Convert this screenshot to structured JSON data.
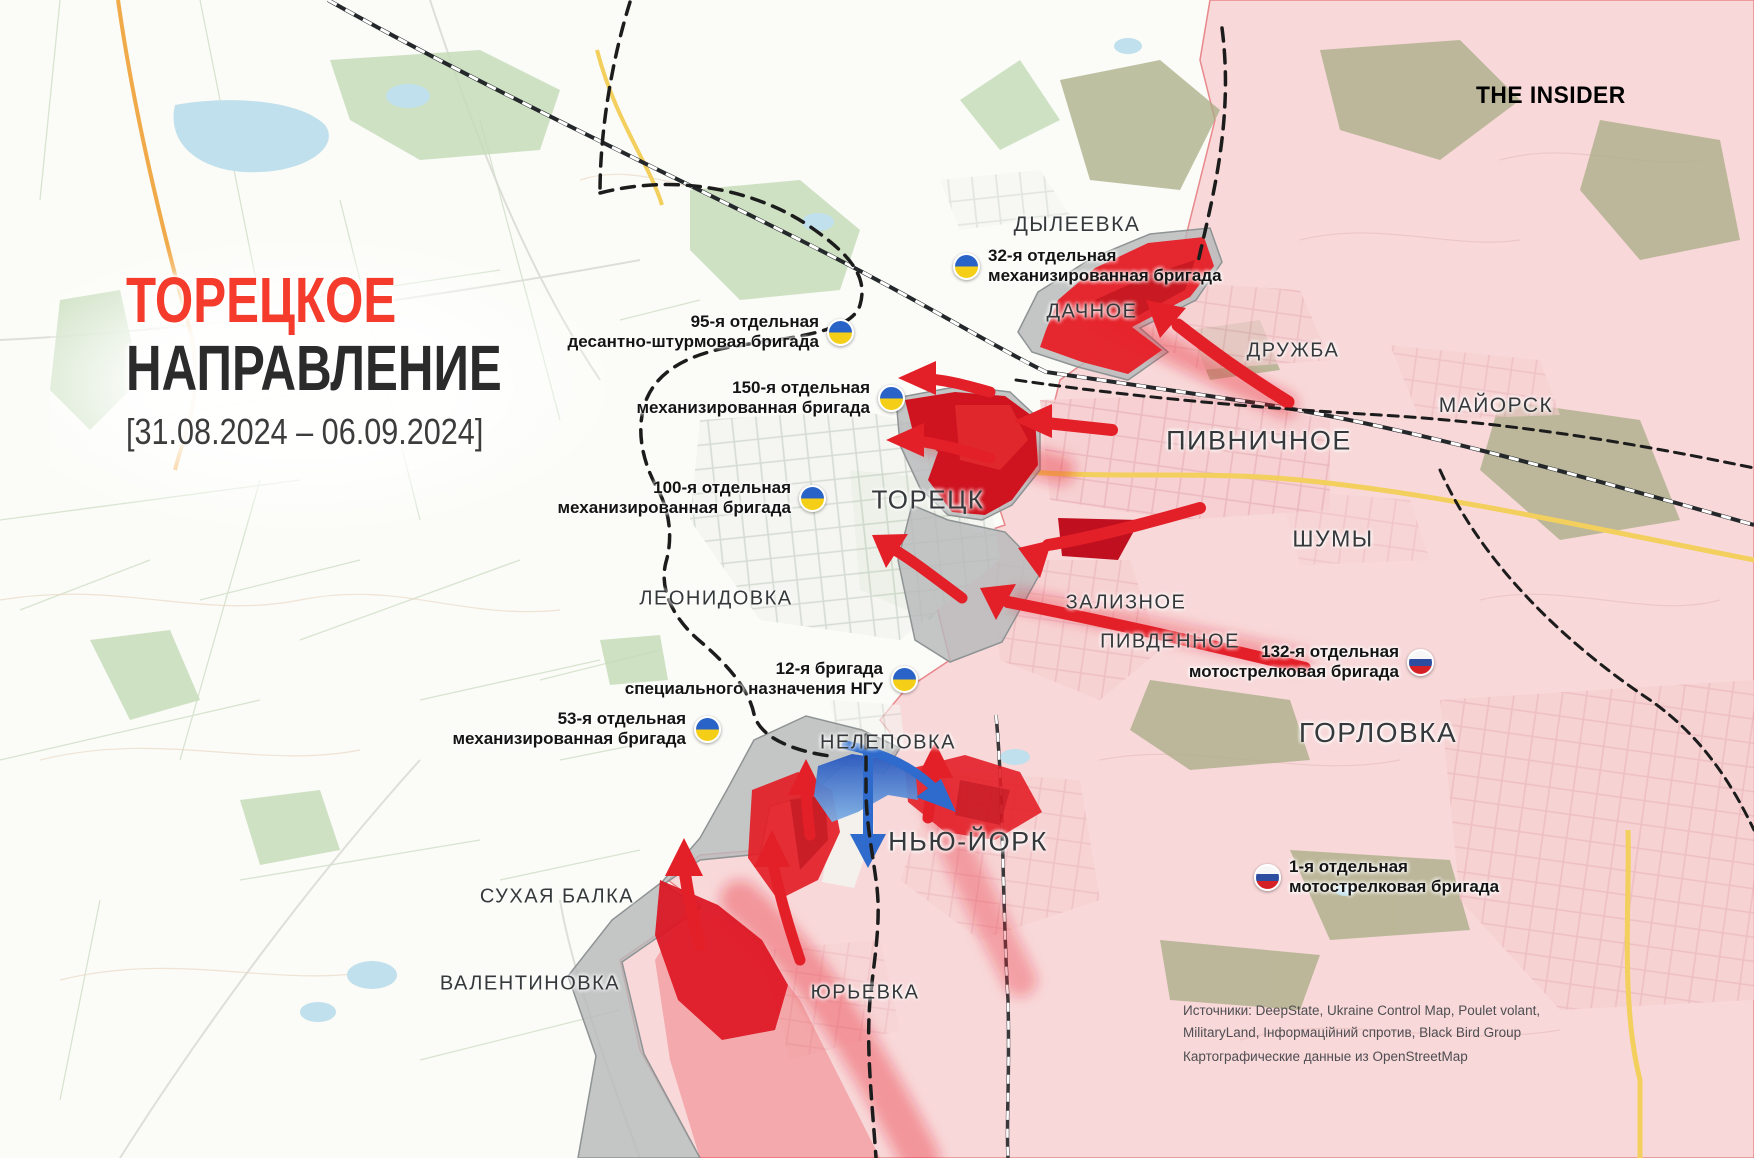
{
  "title": {
    "line1": "ТОРЕЦКОЕ",
    "line2": "НАПРАВЛЕНИЕ",
    "date_range": "[31.08.2024 – 06.09.2024]"
  },
  "logo": {
    "text": "THE INSIDER"
  },
  "colors": {
    "title_red": "#f43b2c",
    "label_dark": "#2b2b2b",
    "occupied_pink": "#f8d8d9",
    "advance_red": "#e31f28",
    "advance_dark_red": "#b50f1c",
    "contested_gray": "#b7babb",
    "ukraine_blue": "#2a63c8",
    "ukraine_yellow": "#f5cf17",
    "russia_blue": "#2c4da0",
    "russia_red": "#d52026"
  },
  "places": [
    {
      "id": "dyleevka",
      "label": "ДЫЛЕЕВКА",
      "x": 1077,
      "y": 225,
      "size": 21
    },
    {
      "id": "dachnoe",
      "label": "ДАЧНОЕ",
      "x": 1092,
      "y": 312,
      "size": 20
    },
    {
      "id": "druzhba",
      "label": "ДРУЖБА",
      "x": 1293,
      "y": 351,
      "size": 20
    },
    {
      "id": "mayorsk",
      "label": "МАЙОРСК",
      "x": 1496,
      "y": 406,
      "size": 21
    },
    {
      "id": "pivnichnoe",
      "label": "ПИВНИЧНОЕ",
      "x": 1259,
      "y": 441,
      "size": 27
    },
    {
      "id": "shumy",
      "label": "ШУМЫ",
      "x": 1333,
      "y": 539,
      "size": 23
    },
    {
      "id": "toretsk",
      "label": "ТОРЕЦК",
      "x": 928,
      "y": 500,
      "size": 26
    },
    {
      "id": "zalizne",
      "label": "ЗАЛИЗНОЕ",
      "x": 1126,
      "y": 603,
      "size": 20
    },
    {
      "id": "pivdennoe",
      "label": "ПИВДЕННОЕ",
      "x": 1170,
      "y": 642,
      "size": 20
    },
    {
      "id": "leonidovka",
      "label": "ЛЕОНИДОВКА",
      "x": 716,
      "y": 599,
      "size": 20
    },
    {
      "id": "nelepovka",
      "label": "НЕЛЕПОВКА",
      "x": 888,
      "y": 743,
      "size": 20
    },
    {
      "id": "new-york",
      "label": "НЬЮ-ЙОРК",
      "x": 968,
      "y": 842,
      "size": 27
    },
    {
      "id": "gorlovka",
      "label": "ГОРЛОВКА",
      "x": 1378,
      "y": 733,
      "size": 28
    },
    {
      "id": "sukhaya-balka",
      "label": "СУХАЯ БАЛКА",
      "x": 557,
      "y": 897,
      "size": 20
    },
    {
      "id": "valentinovka",
      "label": "ВАЛЕНТИНОВКА",
      "x": 530,
      "y": 984,
      "size": 20
    },
    {
      "id": "yuryevka",
      "label": "ЮРЬЕВКА",
      "x": 865,
      "y": 993,
      "size": 20
    }
  ],
  "units": [
    {
      "id": "ua-32",
      "flag": "ua",
      "flag_side": "left",
      "lines": [
        "32-я отдельная",
        "механизированная бригада"
      ],
      "x": 967,
      "y": 266
    },
    {
      "id": "ua-95",
      "flag": "ua",
      "flag_side": "right",
      "lines": [
        "95-я отдельная",
        "десантно-штурмовая бригада"
      ],
      "x": 840,
      "y": 332
    },
    {
      "id": "ua-150",
      "flag": "ua",
      "flag_side": "right",
      "lines": [
        "150-я отдельная",
        "механизированная бригада"
      ],
      "x": 891,
      "y": 398
    },
    {
      "id": "ua-100",
      "flag": "ua",
      "flag_side": "right",
      "lines": [
        "100-я отдельная",
        "механизированная бригада"
      ],
      "x": 812,
      "y": 498
    },
    {
      "id": "ua-12",
      "flag": "ua",
      "flag_side": "right",
      "lines": [
        "12-я бригада",
        "специального назначения НГУ"
      ],
      "x": 904,
      "y": 679
    },
    {
      "id": "ua-53",
      "flag": "ua",
      "flag_side": "right",
      "lines": [
        "53-я отдельная",
        "механизированная бригада"
      ],
      "x": 707,
      "y": 729
    },
    {
      "id": "ru-132",
      "flag": "ru",
      "flag_side": "right",
      "lines": [
        "132-я отдельная",
        "мотострелковая бригада"
      ],
      "x": 1420,
      "y": 662
    },
    {
      "id": "ru-1",
      "flag": "ru",
      "flag_side": "left",
      "lines": [
        "1-я отдельная",
        "мотострелковая бригада"
      ],
      "x": 1268,
      "y": 877
    }
  ],
  "sources": {
    "line1": "Источники: DeepState, Ukraine Control Map, Poulet volant,",
    "line2": "MilitaryLand, Інформаційний спротив, Black Bird Group",
    "line3": "Картографические данные из OpenStreetMap"
  }
}
